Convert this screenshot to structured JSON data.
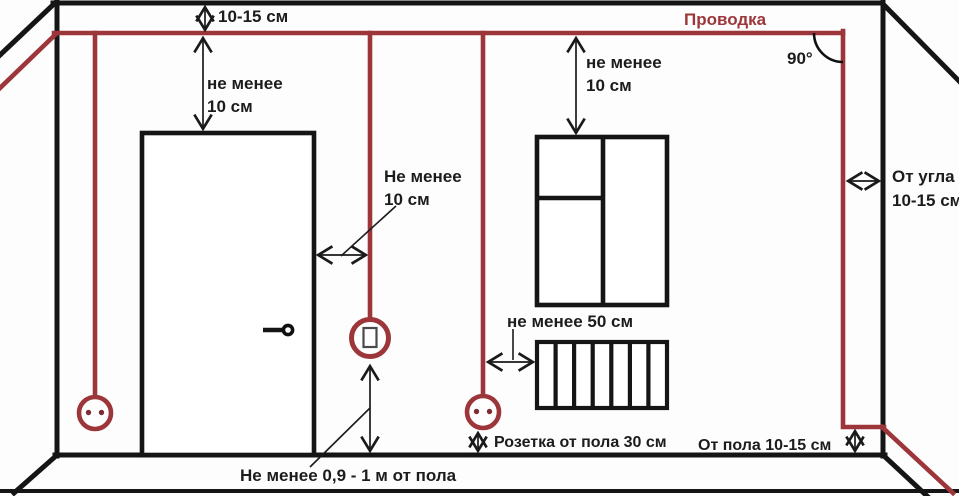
{
  "diagram": {
    "title": "Схема прокладки электропроводки в комнате",
    "colors": {
      "wire": "#9d363b",
      "lines": "#151515",
      "text": "#1c1c1c"
    },
    "labels": {
      "wiring_title": "Проводка",
      "right_angle": "90°",
      "ceiling_offset": "10-15 см",
      "wire_to_door_top": {
        "line1": "не менее",
        "line2": "10 см"
      },
      "wire_to_window_top": {
        "line1": "не менее",
        "line2": "10 см"
      },
      "door_side_clearance": {
        "line1": "Не менее",
        "line2": "10 см"
      },
      "corner_offset": {
        "line1": "От угла",
        "line2": "10-15 см"
      },
      "radiator_clearance": "не менее 50 см",
      "socket_floor_height": "Розетка от пола 30 см",
      "wire_floor_offset": "От пола 10-15 см",
      "switch_floor_height": "Не менее 0,9 - 1 м от пола"
    }
  }
}
